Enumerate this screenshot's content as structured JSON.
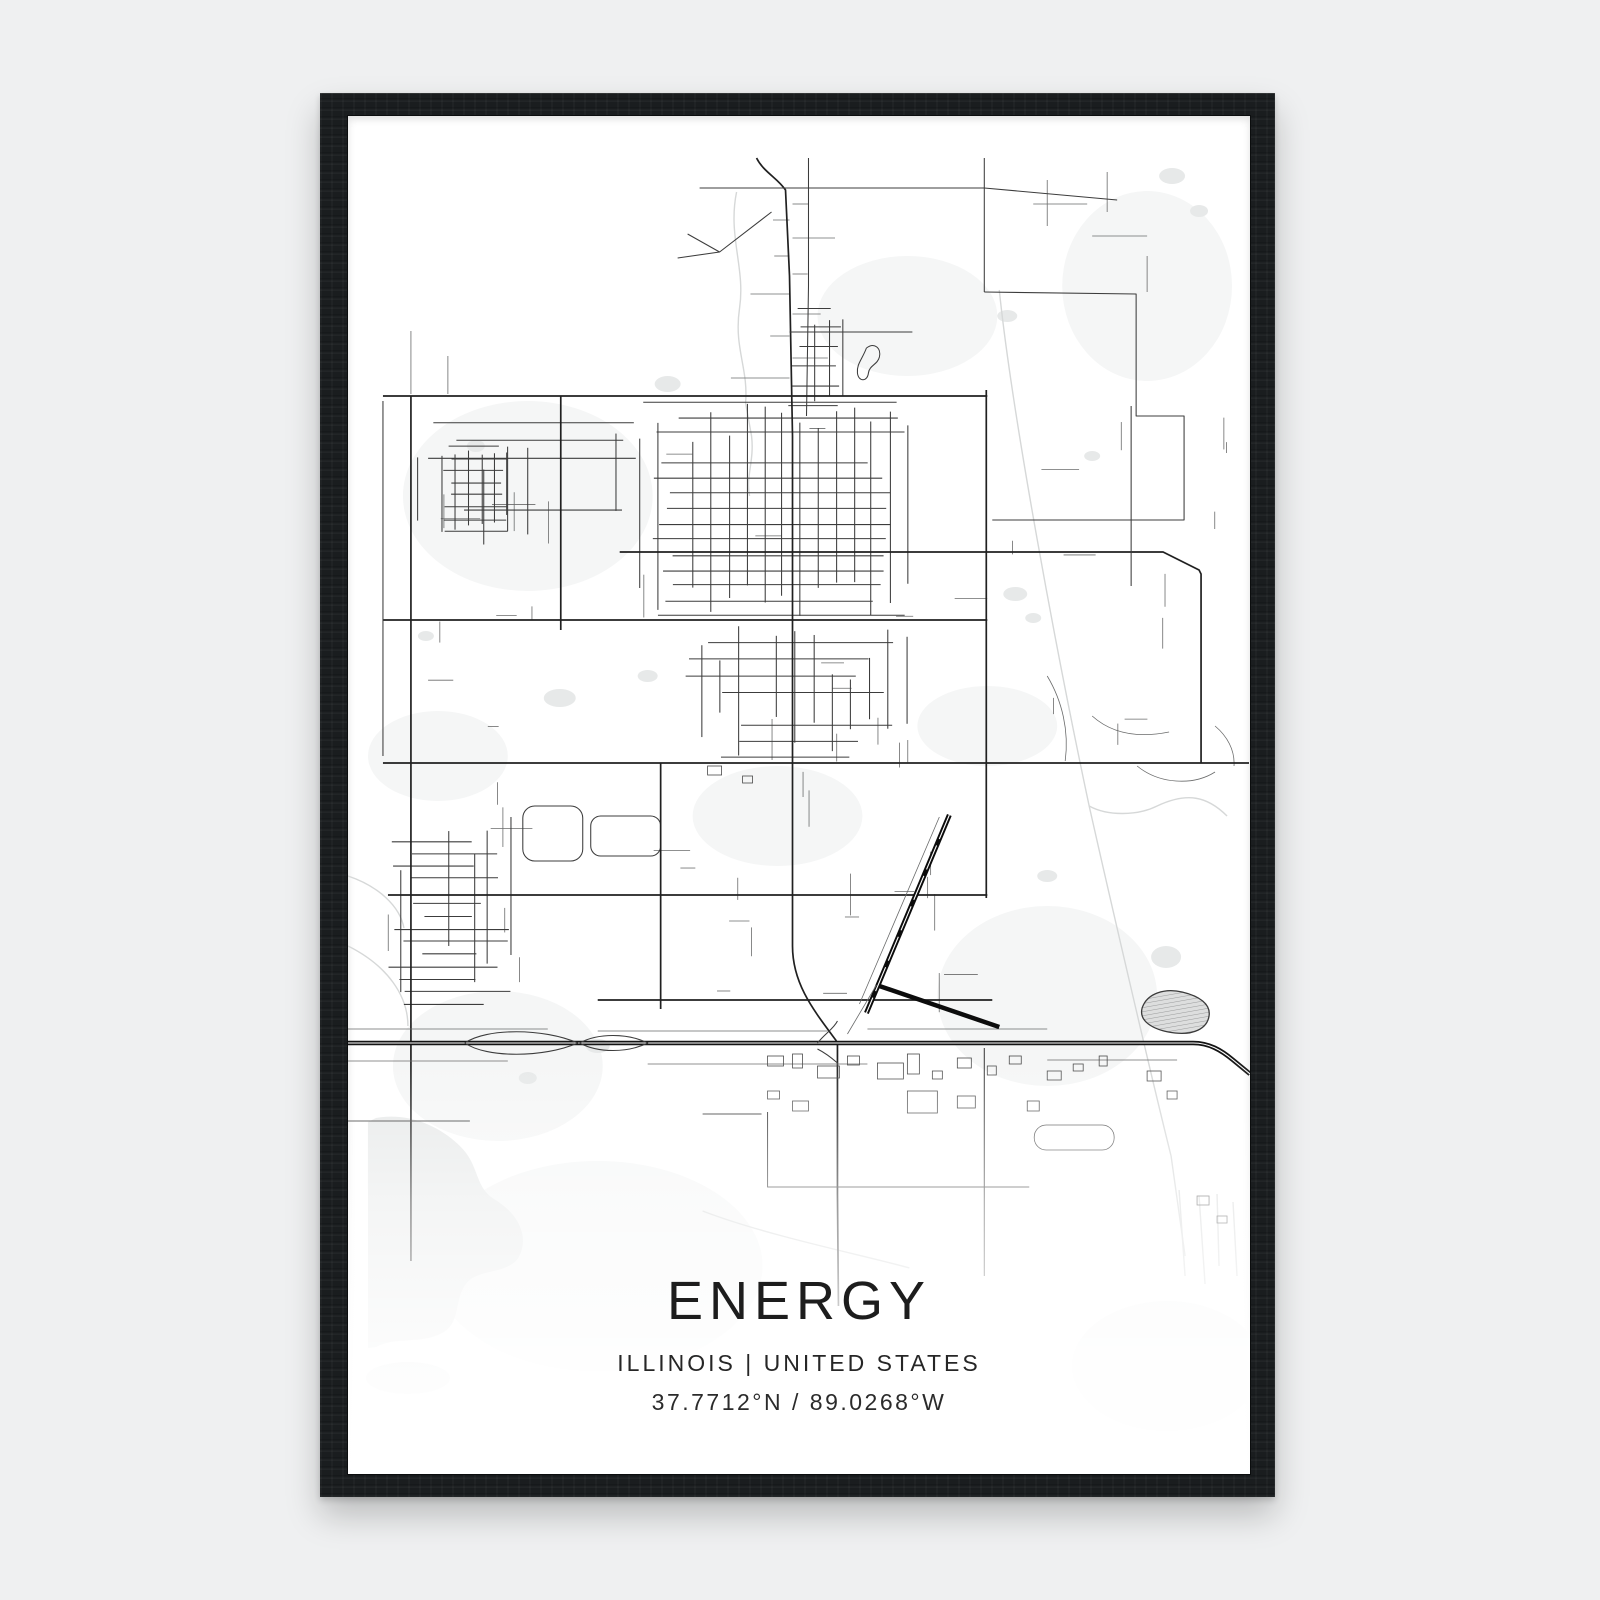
{
  "poster": {
    "title": "ENERGY",
    "subtitle": "ILLINOIS | UNITED STATES",
    "coordinates": "37.7712°N / 89.0268°W"
  },
  "colors": {
    "page_background": "#eff0f1",
    "frame": "#1a1d1f",
    "paper": "#ffffff",
    "roads_dark": "#202020",
    "roads_light": "#6a6b6b",
    "water": "#e7e9e9",
    "text": "#1d1d1d"
  }
}
